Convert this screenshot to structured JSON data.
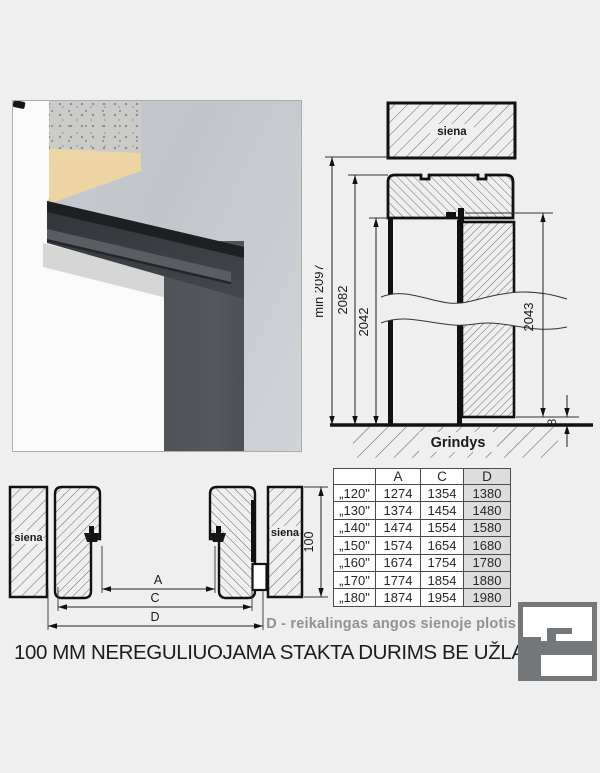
{
  "title": "100 MM NEREGULIUOJAMA STAKTA DURIMS BE UŽLAIDOS",
  "caption": "D - reikalingas angos sienoje plotis",
  "elevation": {
    "wall_label": "siena",
    "floor_label": "Grindys",
    "dim_min_total": "min 2097",
    "dim_frame": "2082",
    "dim_opening": "2042",
    "dim_leaf": "2043",
    "dim_floor_gap": "8"
  },
  "section": {
    "wall_label_left": "siena",
    "wall_label_right": "siena",
    "dim_a": "A",
    "dim_c": "C",
    "dim_d": "D",
    "dim_depth": "100"
  },
  "table": {
    "headers": [
      "",
      "A",
      "C",
      "D"
    ],
    "rows": [
      [
        "„120\"",
        "1274",
        "1354",
        "1380"
      ],
      [
        "„130\"",
        "1374",
        "1454",
        "1480"
      ],
      [
        "„140\"",
        "1474",
        "1554",
        "1580"
      ],
      [
        "„150\"",
        "1574",
        "1654",
        "1680"
      ],
      [
        "„160\"",
        "1674",
        "1754",
        "1780"
      ],
      [
        "„170\"",
        "1774",
        "1854",
        "1880"
      ],
      [
        "„180\"",
        "1874",
        "1954",
        "1980"
      ]
    ]
  },
  "colors": {
    "background": "#efeff0",
    "frame_anthracite": "#44484d",
    "wood_layer": "#e0b87d",
    "highlight_column": "#dcdddd",
    "logo_gray": "#75787b"
  }
}
